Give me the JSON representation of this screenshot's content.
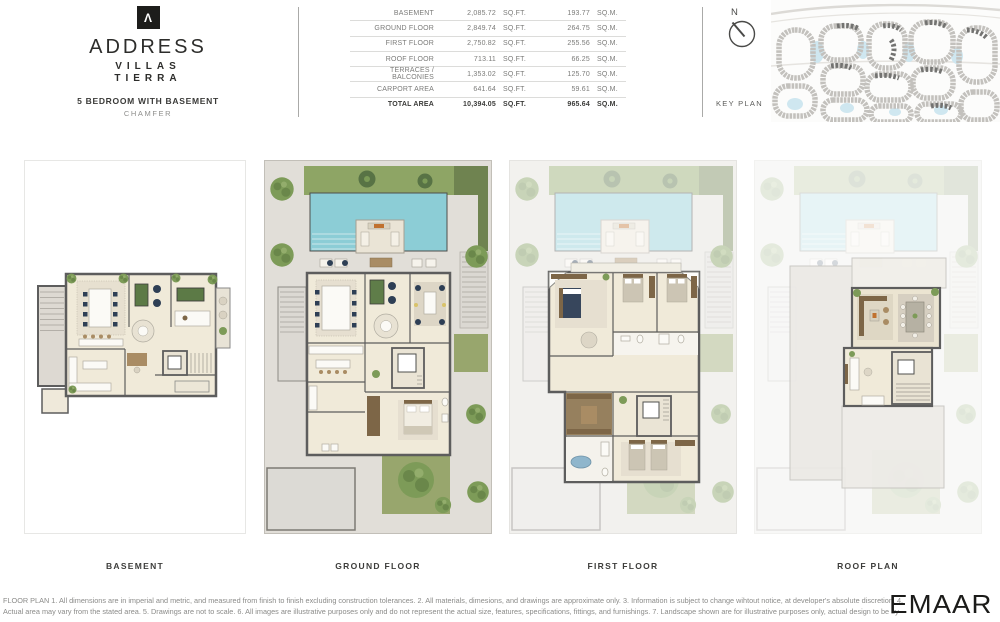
{
  "brand": {
    "logo_icon": "address-caret-icon",
    "logo_glyph": "Λ",
    "name": "ADDRESS",
    "sub_name_line1": "VILLAS",
    "sub_name_line2": "TIERRA",
    "unit_type": "5 BEDROOM WITH BASEMENT",
    "variant": "CHAMFER"
  },
  "area_table": {
    "sqft_unit": "SQ.FT.",
    "sqm_unit": "SQ.M.",
    "rows": [
      {
        "label": "BASEMENT",
        "sqft": "2,085.72",
        "sqm": "193.77"
      },
      {
        "label": "GROUND FLOOR",
        "sqft": "2,849.74",
        "sqm": "264.75"
      },
      {
        "label": "FIRST FLOOR",
        "sqft": "2,750.82",
        "sqm": "255.56"
      },
      {
        "label": "ROOF FLOOR",
        "sqft": "713.11",
        "sqm": "66.25"
      },
      {
        "label": "TERRACES / BALCONIES",
        "sqft": "1,353.02",
        "sqm": "125.70"
      },
      {
        "label": "CARPORT AREA",
        "sqft": "641.64",
        "sqm": "59.61"
      },
      {
        "label": "TOTAL AREA",
        "sqft": "10,394.05",
        "sqm": "965.64"
      }
    ]
  },
  "key_plan": {
    "north_label": "N",
    "title": "KEY PLAN"
  },
  "plans": [
    {
      "label": "BASEMENT"
    },
    {
      "label": "GROUND FLOOR"
    },
    {
      "label": "FIRST FLOOR"
    },
    {
      "label": "ROOF PLAN"
    }
  ],
  "footer": {
    "disclaimer": "FLOOR PLAN 1. All dimensions are in imperial and metric, and measured from finish to finish excluding construction tolerances. 2. All materials, dimesions, and drawings are approximate only. 3. Information is subject to change wihtout notice, at developer's absolute discretion. 4. Actual area may vary from the stated area. 5. Drawings are not to scale. 6. All images are illustrative purposes only and do not represent the actual size, features, specifications, fittings, and furnishings. 7. Landscape shown are for illustrative purposes only, actual design to be by owner.",
    "developer_logo": "EMAAR"
  },
  "colors": {
    "brand_black": "#1d1d1b",
    "pool": "#8ccdd6",
    "grass": "#8ea565",
    "hedge": "#6f8350",
    "garden": "#98a66d",
    "floor_beige": "#f0ead9",
    "wall_gray": "#5d5d5d",
    "paving": "#e1ded8",
    "keyplan_water": "#cfe7f0"
  }
}
